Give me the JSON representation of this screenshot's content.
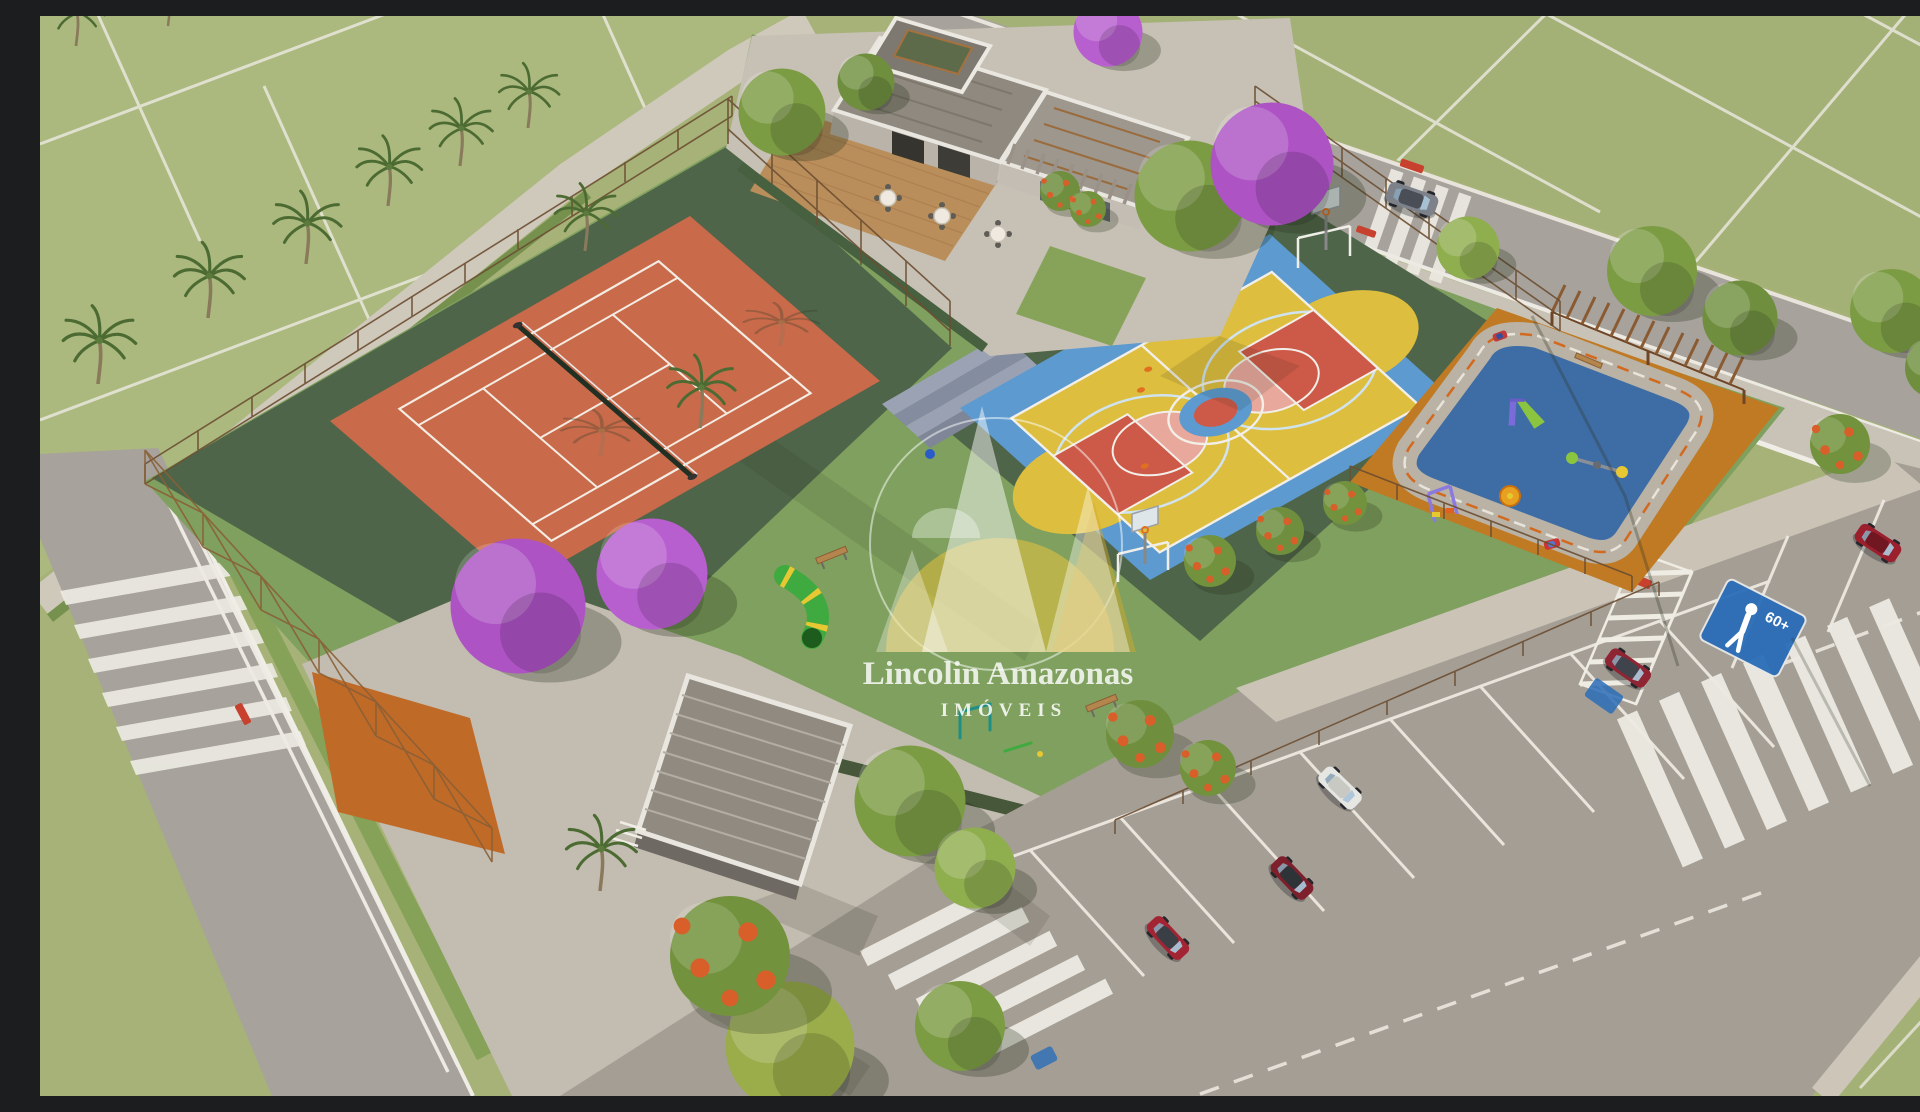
{
  "watermark": {
    "brand": "Lincolin Amazonas",
    "tagline": "IMÓVEIS"
  },
  "signs": {
    "senior_parking_label": "60+",
    "senior_parking_icon": "person-walking-icon"
  },
  "scene": {
    "type": "aerial-3d-architectural-rendering",
    "visible_areas": [
      "grass lots",
      "tennis court",
      "multisport court",
      "kids playground with mini traffic track",
      "clubhouse deck",
      "restroom building",
      "parking lot",
      "roads with crosswalks"
    ]
  },
  "palette": {
    "grass_field": "#a6b277",
    "leisure_lawn": "#7fa05e",
    "court_apron_green": "#4f6549",
    "tennis_clay": "#c96a4a",
    "court_blue": "#5c9ad0",
    "court_yellow": "#ddbe3e",
    "court_red": "#cd5948",
    "playground_rubber_orange": "#c07a24",
    "playground_blue": "#3e6da6",
    "road_gray": "#a7a29b",
    "sidewalk": "#c9c3b7",
    "parking_sign_blue": "#2a6db8",
    "jacaranda_purple": "#ad53c4",
    "watermark_yellow": "#ecc53e",
    "watermark_white": "#ffffff"
  }
}
